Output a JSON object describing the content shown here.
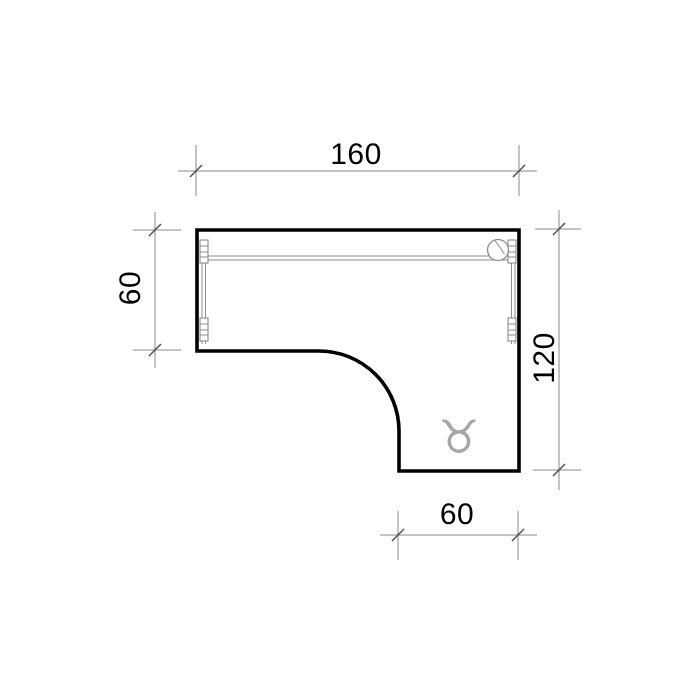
{
  "drawing": {
    "dimensions": {
      "top": "160",
      "left": "60",
      "right": "120",
      "bottom": "60"
    },
    "icons": {
      "logo_glyph": "♉"
    },
    "colors": {
      "background": "#ffffff",
      "outline": "#000000",
      "dimension_line": "#8a8a8a",
      "tick": "#4d4d4d",
      "label": "#000000",
      "detail": "#8c8c8c",
      "logo": "#a6a6a6"
    }
  }
}
